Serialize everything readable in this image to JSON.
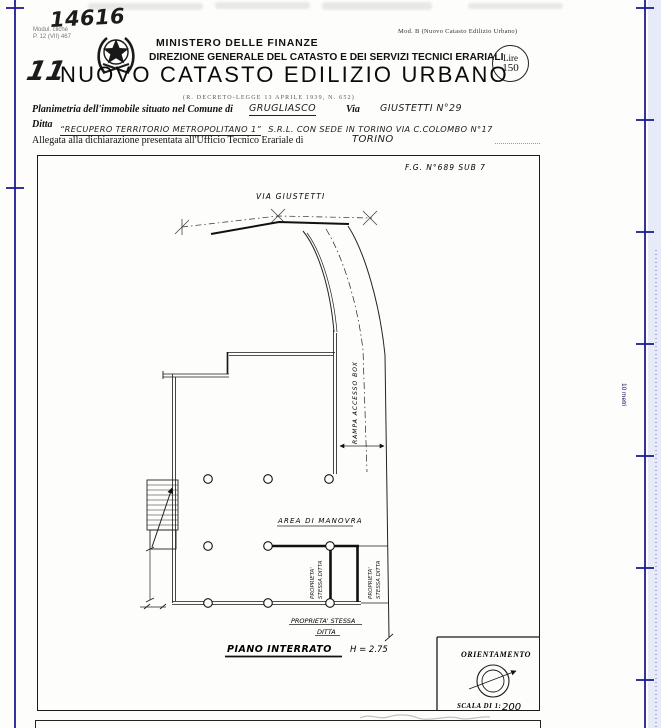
{
  "colors": {
    "ruler_blue": "#1e1e8f",
    "paper": "#fdfdfb",
    "ink": "#111111",
    "margin_tint": "#e7ebf7"
  },
  "header": {
    "protocol_number": "14616",
    "small_print_line1": "Modul. cliché",
    "small_print_line2": "P. 12 (VII) 467",
    "mod_label": "Mod. B (Nuovo Catasto Edilizio Urbano)",
    "ministry": "MINISTERO DELLE FINANZE",
    "direction": "DIREZIONE GENERALE DEL CATASTO E DEI SERVIZI TECNICI ERARIALI",
    "stamp_currency": "Lire",
    "stamp_value": "150",
    "handwritten_prefix": "11",
    "title": "NUOVO CATASTO EDILIZIO URBANO",
    "subtitle": "(R. DECRETO-LEGGE 13 APRILE 1939, N. 652)"
  },
  "form": {
    "line1_label": "Planimetria dell'immobile situato nel Comune di",
    "line1_comune": "GRUGLIASCO",
    "line1_via_label": "Via",
    "line1_via": "GIUSTETTI N°29",
    "line2_label": "Ditta",
    "line2_firm": "“RECUPERO TERRITORIO METROPOLITANO 1”",
    "line2_rest": "S.R.L. CON SEDE IN TORINO VIA C.COLOMBO N°17",
    "line3_label": "Allegata alla dichiarazione presentata all'Ufficio Tecnico Erariale di",
    "line3_office": "TORINO"
  },
  "drawing": {
    "sheet_ref": "F.G. N°689 SUB 7",
    "street_label": "VIA GIUSTETTI",
    "ramp_label": "RAMPA ACCESSO BOX",
    "area_label": "AREA DI MANOVRA",
    "property_vertical_line1": "PROPRIETA'",
    "property_vertical_line2": "STESSA DITTA",
    "property_bottom_line1": "PROPRIETA' STESSA",
    "property_bottom_line2": "DITTA",
    "floor_label": "PIANO INTERRATO",
    "floor_height": "H = 2.75",
    "orientation_label": "ORIENTAMENTO",
    "scale_label": "SCALA DI 1:",
    "scale_value": "200"
  },
  "ruler": {
    "label": "10 metri"
  }
}
